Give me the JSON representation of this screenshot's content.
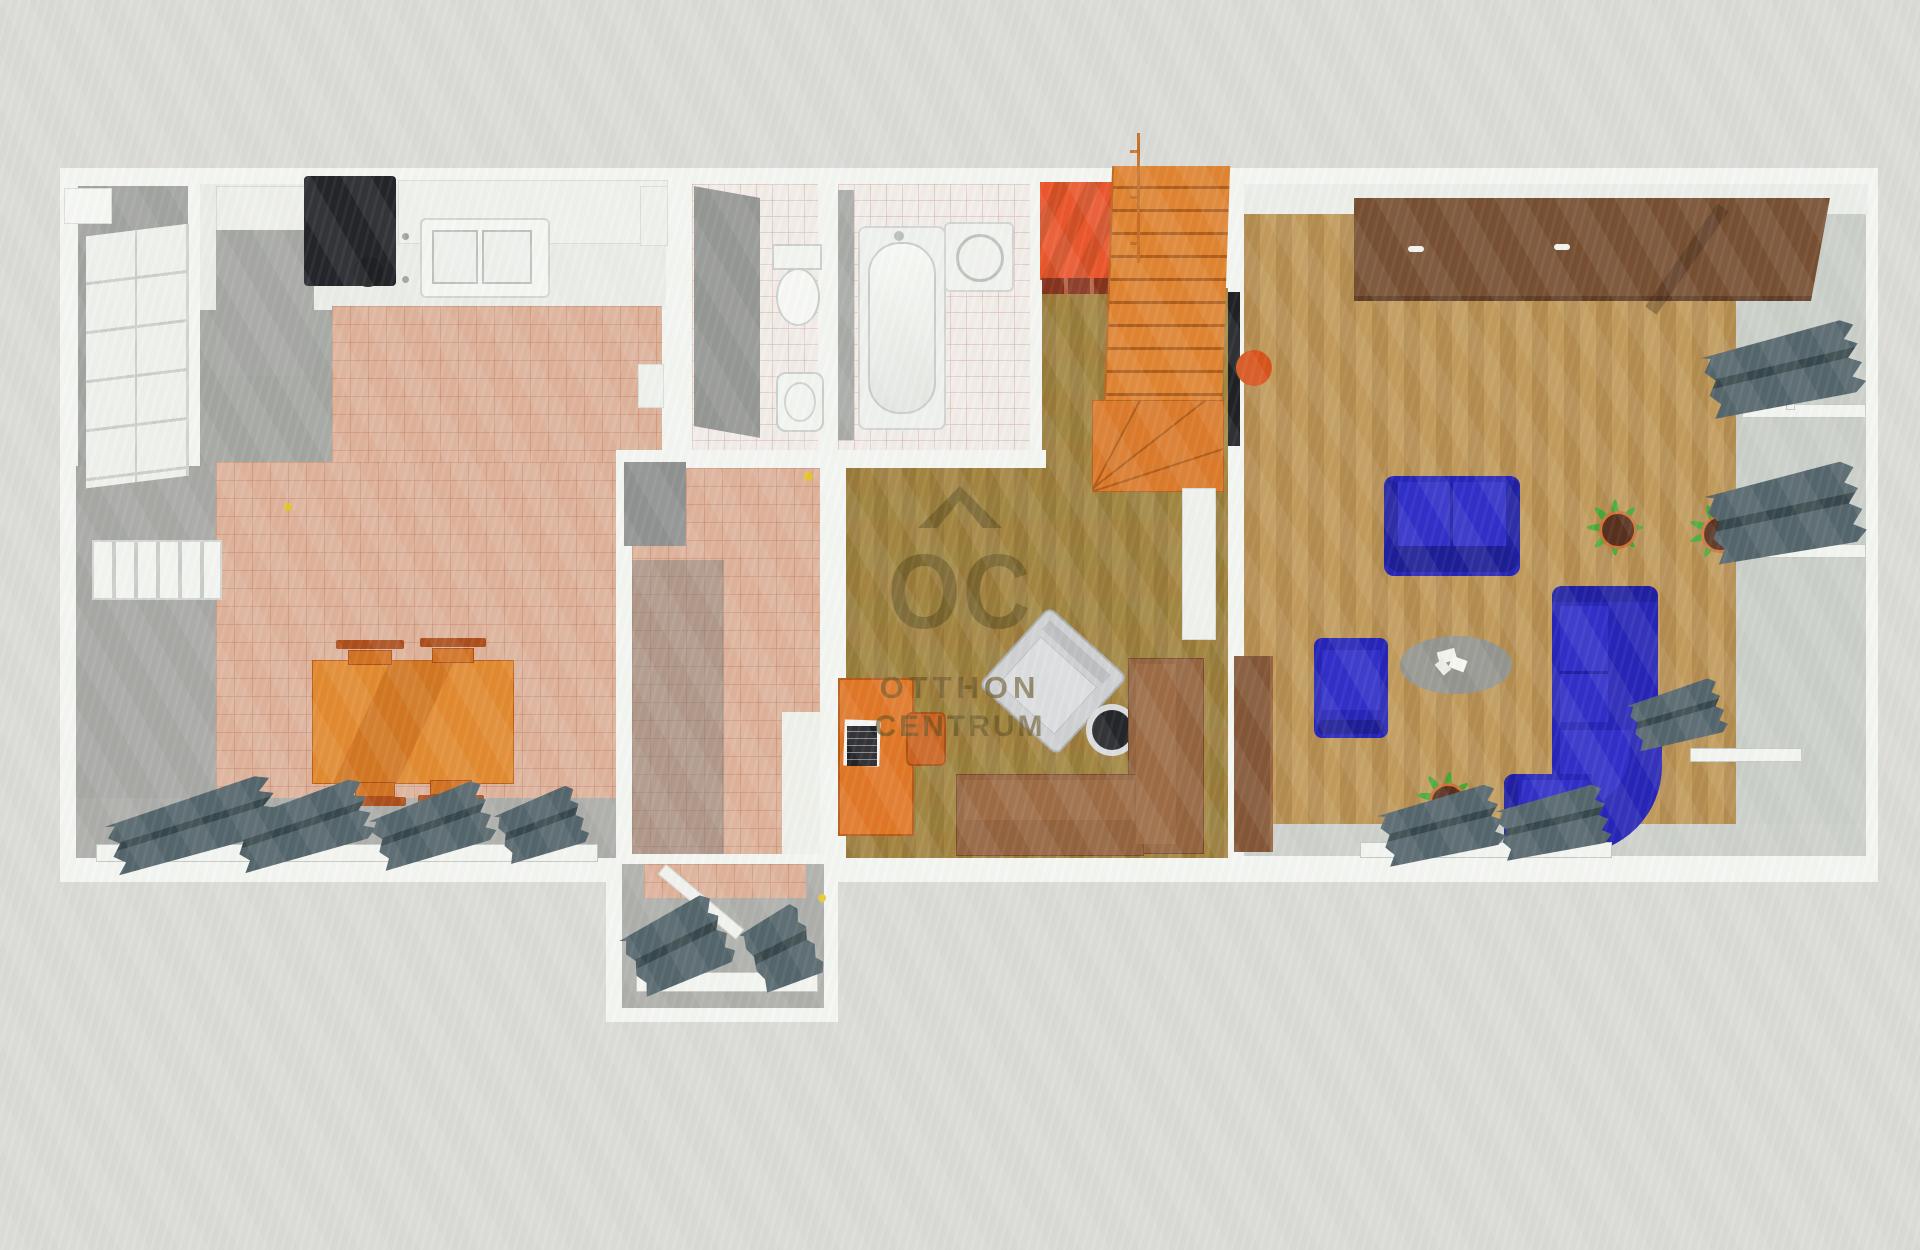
{
  "watermark": {
    "abbrev": "OC",
    "line1": "OTTHON",
    "line2": "CENTRUM"
  },
  "palette": {
    "background": "#d8d8d4",
    "wall_white": "#f3f5f1",
    "terracotta_tile": "#dcae96",
    "bathroom_tile": "#f1ece8",
    "study_floor_olive": "#9a8038",
    "living_floor_tan": "#b9914f",
    "stair_orange": "#de7d26",
    "landing_red": "#cf4418",
    "sofa_blue": "#1918b3",
    "sofa_brown": "#8d5a33",
    "wardrobe_brown": "#6f4526",
    "dining_table_orange": "#df7a1e",
    "radiator_slate": "#46595f",
    "appliance_black": "#16181d",
    "watermark_color": "rgba(90,72,22,0.62)"
  },
  "scene": {
    "type": "3d-floor-plan-top-down-photo",
    "rooms": [
      "closet",
      "kitchen",
      "dining-area",
      "hallway",
      "wc",
      "bathroom",
      "staircase",
      "study",
      "living-room",
      "entry-porch"
    ],
    "furniture": [
      "black-range",
      "kitchen-sink-counter",
      "fridge-cabinet",
      "tall-shelf-unit",
      "orange-dining-table",
      "four-dining-chairs",
      "radiators",
      "toilet",
      "bidet",
      "bathtub",
      "washing-machine",
      "orange-staircase",
      "red-landing-carpet",
      "orange-desk",
      "laptop",
      "desk-chair",
      "gray-armchair",
      "round-black-side-table",
      "brown-corner-sofa",
      "white-door-leaf",
      "brown-wardrobe",
      "wall-tv",
      "blue-loveseat",
      "blue-armchair",
      "blue-corner-sectional",
      "oval-gray-rug",
      "potted-plants",
      "brown-console-desk",
      "open-entry-door"
    ]
  }
}
